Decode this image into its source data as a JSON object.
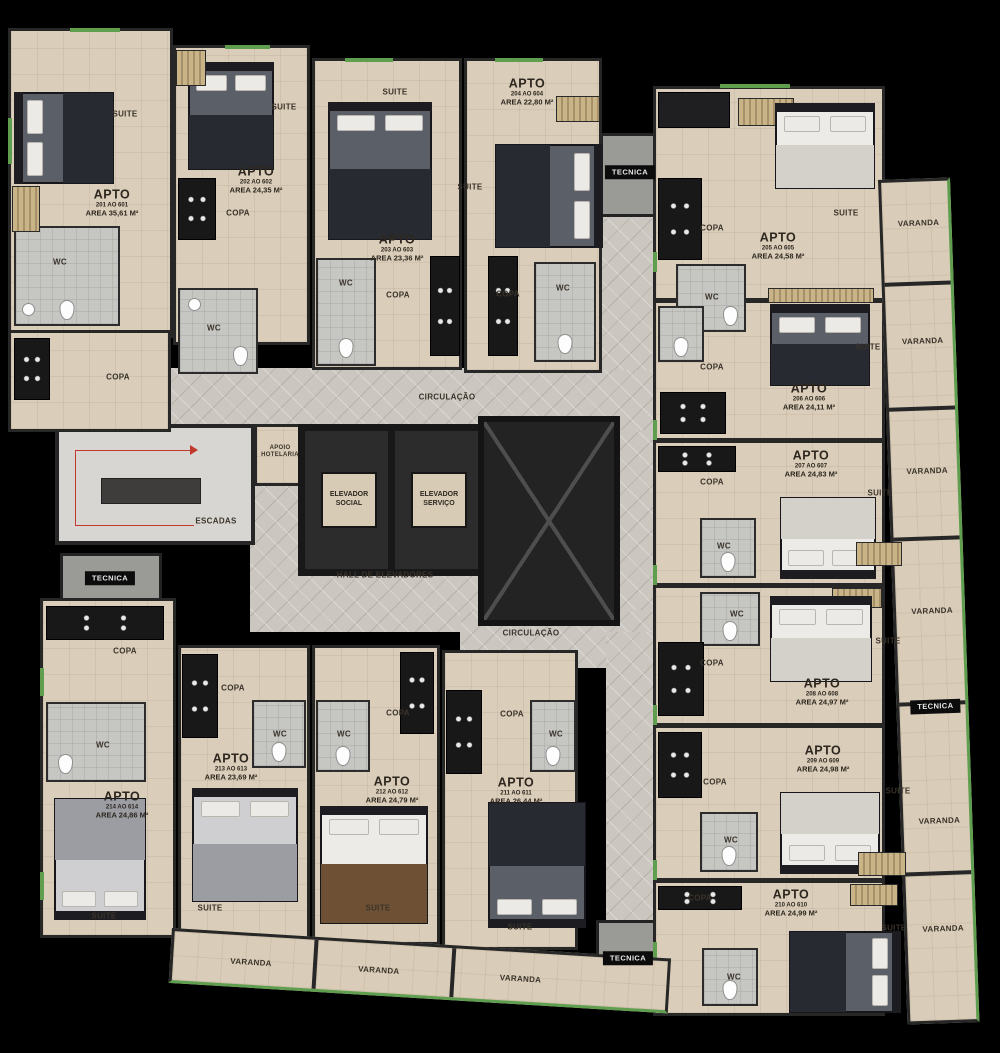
{
  "title": "Planta baixa do pavimento tipo",
  "labels": {
    "apto": "APTO",
    "suite": "SUITE",
    "wc": "WC",
    "copa": "COPA",
    "varanda": "VARANDA",
    "tecnica": "TECNICA",
    "circulacao": "CIRCULAÇÃO",
    "escadas": "ESCADAS",
    "apoio_hotelaria": "APOIO HOTELARIA",
    "elevador_social": "ELEVADOR SOCIAL",
    "elevador_servico": "ELEVADOR SERVIÇO",
    "hall_elevadores": "HALL DE ELEVADORES"
  },
  "apartments": [
    {
      "unit": "201 AO 601",
      "area": "AREA 35,61 M²"
    },
    {
      "unit": "202 AO 602",
      "area": "AREA 24,35 M²"
    },
    {
      "unit": "203 AO 603",
      "area": "AREA 23,36 M²"
    },
    {
      "unit": "204 AO 604",
      "area": "AREA 22,80 M²"
    },
    {
      "unit": "205 AO 605",
      "area": "AREA 24,58 M²"
    },
    {
      "unit": "206 AO 606",
      "area": "AREA 24,11 M²"
    },
    {
      "unit": "207 AO 607",
      "area": "AREA 24,83 M²"
    },
    {
      "unit": "208 AO 608",
      "area": "AREA 24,97 M²"
    },
    {
      "unit": "209 AO 609",
      "area": "AREA 24,98 M²"
    },
    {
      "unit": "210 AO 610",
      "area": "AREA 24,99 M²"
    },
    {
      "unit": "211 AO 611",
      "area": "AREA 26,44 M²"
    },
    {
      "unit": "212 AO 612",
      "area": "AREA 24,79 M²"
    },
    {
      "unit": "213 AO 613",
      "area": "AREA 23,69 M²"
    },
    {
      "unit": "214 AO 614",
      "area": "AREA 24,86 M²"
    }
  ],
  "colors": {
    "background": "#000000",
    "apartment_floor": "#dacdb9",
    "corridor_floor": "#cbc7c0",
    "wall": "#272727",
    "balcony_accent": "#5f9e4f",
    "stairs_path": "#c0392b"
  }
}
